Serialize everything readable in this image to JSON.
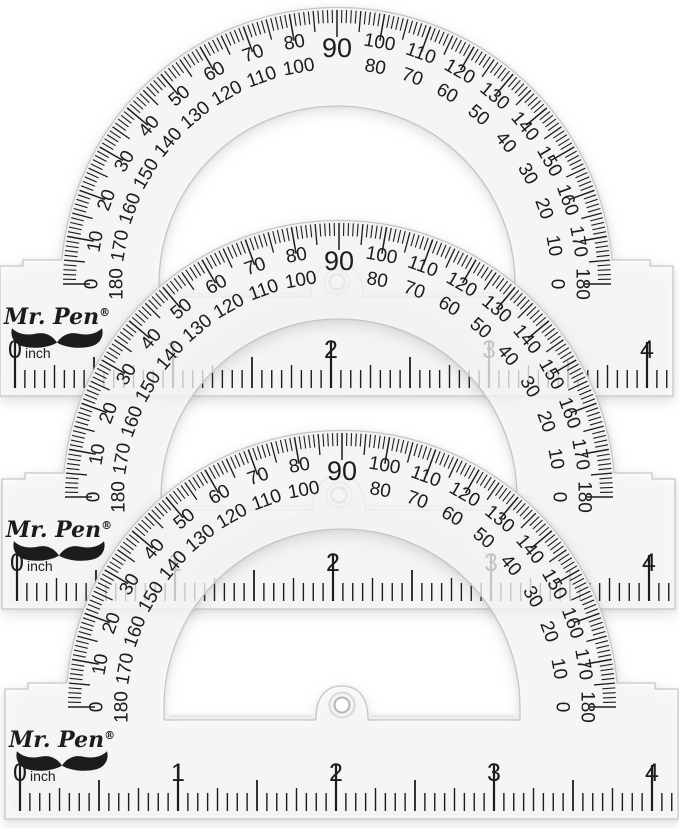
{
  "image": {
    "kind": "product-photo",
    "subject": "Three stacked clear plastic protractors",
    "background_color": "#ffffff"
  },
  "brand": {
    "name_main": "Mr. Pen",
    "registered": "®",
    "logo_icon": "mustache-icon"
  },
  "colors": {
    "ink": "#1c1c1c",
    "plastic_fill": "rgba(255,255,255,0.72)",
    "plastic_edge": "#c6c6c6",
    "bevel": "#e6e6e6",
    "rim_band": "#f2f2f2",
    "hole_edge": "#b5b5b5",
    "boss_edge": "#d8d8d8"
  },
  "protractors": [
    {
      "id": "top",
      "position": "back"
    },
    {
      "id": "middle",
      "position": "middle"
    },
    {
      "id": "bottom",
      "position": "front"
    }
  ],
  "degrees": {
    "top": "90",
    "pairs": [
      {
        "angle": 0,
        "outer": "0",
        "inner": "180"
      },
      {
        "angle": 10,
        "outer": "10",
        "inner": "170"
      },
      {
        "angle": 20,
        "outer": "20",
        "inner": "160"
      },
      {
        "angle": 30,
        "outer": "30",
        "inner": "150"
      },
      {
        "angle": 40,
        "outer": "40",
        "inner": "140"
      },
      {
        "angle": 50,
        "outer": "50",
        "inner": "130"
      },
      {
        "angle": 60,
        "outer": "60",
        "inner": "120"
      },
      {
        "angle": 70,
        "outer": "70",
        "inner": "110"
      },
      {
        "angle": 80,
        "outer": "80",
        "inner": "100"
      },
      {
        "angle": 100,
        "outer": "100",
        "inner": "80"
      },
      {
        "angle": 110,
        "outer": "110",
        "inner": "70"
      },
      {
        "angle": 120,
        "outer": "120",
        "inner": "60"
      },
      {
        "angle": 130,
        "outer": "130",
        "inner": "50"
      },
      {
        "angle": 140,
        "outer": "140",
        "inner": "40"
      },
      {
        "angle": 150,
        "outer": "150",
        "inner": "30"
      },
      {
        "angle": 160,
        "outer": "160",
        "inner": "20"
      },
      {
        "angle": 170,
        "outer": "170",
        "inner": "10"
      },
      {
        "angle": 180,
        "outer": "180",
        "inner": "0"
      }
    ],
    "tick_step_deg": 1
  },
  "ruler": {
    "zero": "0",
    "unit": "inch",
    "labels": [
      "1",
      "2",
      "3",
      "4"
    ],
    "divisions_per_inch": 16
  }
}
